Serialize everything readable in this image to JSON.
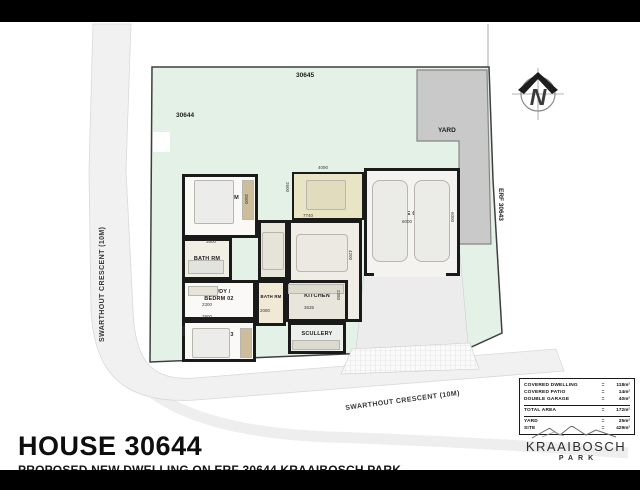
{
  "title_block": {
    "title": "HOUSE 30644",
    "subtitle": "PROPOSED NEW DWELLING ON ERF 30644 KRAAIBOSCH PARK"
  },
  "logo": {
    "brand": "KRAAIBOSCH",
    "brand_sub": "PARK"
  },
  "compass": {
    "letter": "N"
  },
  "area_table": {
    "rows": [
      {
        "label": "COVERED DWELLING",
        "value": "118m²",
        "rule_after": false
      },
      {
        "label": "COVERED PATIO",
        "value": "14m²",
        "rule_after": false
      },
      {
        "label": "DOUBLE GARAGE",
        "value": "40m²",
        "rule_after": true
      },
      {
        "label": "TOTAL AREA",
        "value": "172m²",
        "rule_after": true
      },
      {
        "label": "YARD",
        "value": "25m²",
        "rule_after": false
      },
      {
        "label": "SITE",
        "value": "429m²",
        "rule_after": false
      }
    ]
  },
  "site_labels": [
    {
      "name": "erf-30645-label",
      "text": "30645",
      "x": 296,
      "y": 50,
      "rot": 0,
      "cls": "erf"
    },
    {
      "name": "erf-30644-label",
      "text": "30644",
      "x": 176,
      "y": 90,
      "rot": 0,
      "cls": "erf"
    },
    {
      "name": "erf-30643-label",
      "text": "ERF 30643",
      "x": 504,
      "y": 166,
      "rot": 90,
      "cls": "erf"
    },
    {
      "name": "yard-label",
      "text": "YARD",
      "x": 438,
      "y": 105,
      "rot": 0,
      "cls": "erf"
    },
    {
      "name": "street-left-label",
      "text": "SWARTHOUT CRESCENT (10M)",
      "x": 99,
      "y": 320,
      "rot": -90,
      "cls": "street"
    },
    {
      "name": "street-bottom-label",
      "text": "SWARTHOUT CRESCENT (10M)",
      "x": 345,
      "y": 383,
      "rot": -7.5,
      "cls": "street"
    }
  ],
  "rooms": [
    {
      "name": "main-bedroom",
      "label": "MAIN BEDRM",
      "x": 182,
      "y": 152,
      "w": 76,
      "h": 64,
      "bg": "#faf9f6",
      "ldy": -8
    },
    {
      "name": "bathroom-1",
      "label": "BATH RM",
      "x": 182,
      "y": 216,
      "w": 50,
      "h": 42,
      "bg": "#f1eee4"
    },
    {
      "name": "study-bedroom-02",
      "label": "STUDY /\nBEDRM 02",
      "x": 182,
      "y": 258,
      "w": 74,
      "h": 40,
      "bg": "#faf9f6",
      "ldy": -4
    },
    {
      "name": "bedroom-03",
      "label": "BEDRM 03",
      "x": 182,
      "y": 298,
      "w": 74,
      "h": 42,
      "bg": "#faf9f6",
      "ldy": -6
    },
    {
      "name": "dining-room",
      "label": "DINING",
      "x": 258,
      "y": 198,
      "w": 30,
      "h": 60,
      "bg": "#e9e6da",
      "rot": -90
    },
    {
      "name": "lounge",
      "label": "LOUNGE",
      "x": 288,
      "y": 198,
      "w": 74,
      "h": 102,
      "bg": "#efede6",
      "ldy": -24
    },
    {
      "name": "covered-patio",
      "label": "COVERED\nPATIO",
      "x": 292,
      "y": 150,
      "w": 72,
      "h": 48,
      "bg": "#e9e4c4",
      "bw": 2
    },
    {
      "name": "kitchen",
      "label": "KITCHEN",
      "x": 286,
      "y": 258,
      "w": 62,
      "h": 42,
      "bg": "#e8e5dc",
      "ldy": -5
    },
    {
      "name": "scullery",
      "label": "SCULLERY",
      "x": 288,
      "y": 300,
      "w": 58,
      "h": 32,
      "bg": "#edefec",
      "ldy": -4
    },
    {
      "name": "bathroom-2",
      "label": "BATH RM",
      "x": 256,
      "y": 258,
      "w": 30,
      "h": 46,
      "bg": "#efe9d6",
      "small": true,
      "ldy": -6
    },
    {
      "name": "double-garage",
      "label": "DOUBLE GARAGE",
      "x": 364,
      "y": 146,
      "w": 96,
      "h": 108,
      "bg": "#f4f3f0",
      "ldy": -8
    }
  ],
  "furniture": [
    {
      "name": "bed-main",
      "x": 194,
      "y": 158,
      "w": 40,
      "h": 44,
      "bg": "#ececea",
      "r": 2
    },
    {
      "name": "wardrobe-main",
      "x": 242,
      "y": 158,
      "w": 12,
      "h": 40,
      "bg": "#cdbd9c"
    },
    {
      "name": "bath1-fixtures",
      "x": 188,
      "y": 238,
      "w": 36,
      "h": 14,
      "bg": "#e3e3de"
    },
    {
      "name": "desk-study",
      "x": 188,
      "y": 264,
      "w": 30,
      "h": 10,
      "bg": "#e6e3d8"
    },
    {
      "name": "bed-03",
      "x": 192,
      "y": 306,
      "w": 38,
      "h": 30,
      "bg": "#ececea",
      "r": 2
    },
    {
      "name": "wardrobe-03",
      "x": 240,
      "y": 306,
      "w": 12,
      "h": 30,
      "bg": "#cdbd9c"
    },
    {
      "name": "dining-table",
      "x": 262,
      "y": 210,
      "w": 22,
      "h": 38,
      "bg": "#e6e3d8",
      "r": 2
    },
    {
      "name": "lounge-sofa",
      "x": 296,
      "y": 212,
      "w": 52,
      "h": 38,
      "bg": "#ebe9e1",
      "r": 4
    },
    {
      "name": "patio-set",
      "x": 306,
      "y": 158,
      "w": 40,
      "h": 30,
      "bg": "#e1dcbe",
      "r": 2
    },
    {
      "name": "kitchen-counter",
      "x": 288,
      "y": 262,
      "w": 56,
      "h": 10,
      "bg": "#dcd9cf"
    },
    {
      "name": "scullery-unit",
      "x": 292,
      "y": 318,
      "w": 48,
      "h": 10,
      "bg": "#dcd9cf"
    },
    {
      "name": "car-1",
      "x": 372,
      "y": 158,
      "w": 36,
      "h": 82,
      "bg": "#ebebe7",
      "r": 8
    },
    {
      "name": "car-2",
      "x": 414,
      "y": 158,
      "w": 36,
      "h": 82,
      "bg": "#ebebe7",
      "r": 8
    },
    {
      "name": "garage-door-opening",
      "x": 374,
      "y": 249,
      "w": 72,
      "h": 6,
      "bg": "#f4f3f0",
      "open": true
    }
  ],
  "dimensions": [
    {
      "t": "3900",
      "x": 206,
      "y": 217
    },
    {
      "t": "3500",
      "x": 249,
      "y": 172,
      "r": 90
    },
    {
      "t": "2300",
      "x": 202,
      "y": 280
    },
    {
      "t": "2900",
      "x": 202,
      "y": 292
    },
    {
      "t": "3000",
      "x": 186,
      "y": 304,
      "r": 90
    },
    {
      "t": "2080",
      "x": 260,
      "y": 286
    },
    {
      "t": "3635",
      "x": 304,
      "y": 283
    },
    {
      "t": "2380",
      "x": 341,
      "y": 268,
      "r": 90
    },
    {
      "t": "4090",
      "x": 318,
      "y": 143
    },
    {
      "t": "2600",
      "x": 290,
      "y": 160,
      "r": 90
    },
    {
      "t": "7740",
      "x": 303,
      "y": 191
    },
    {
      "t": "4200",
      "x": 353,
      "y": 228,
      "r": 90
    },
    {
      "t": "6000",
      "x": 402,
      "y": 197
    },
    {
      "t": "6000",
      "x": 455,
      "y": 190,
      "r": 90
    }
  ]
}
